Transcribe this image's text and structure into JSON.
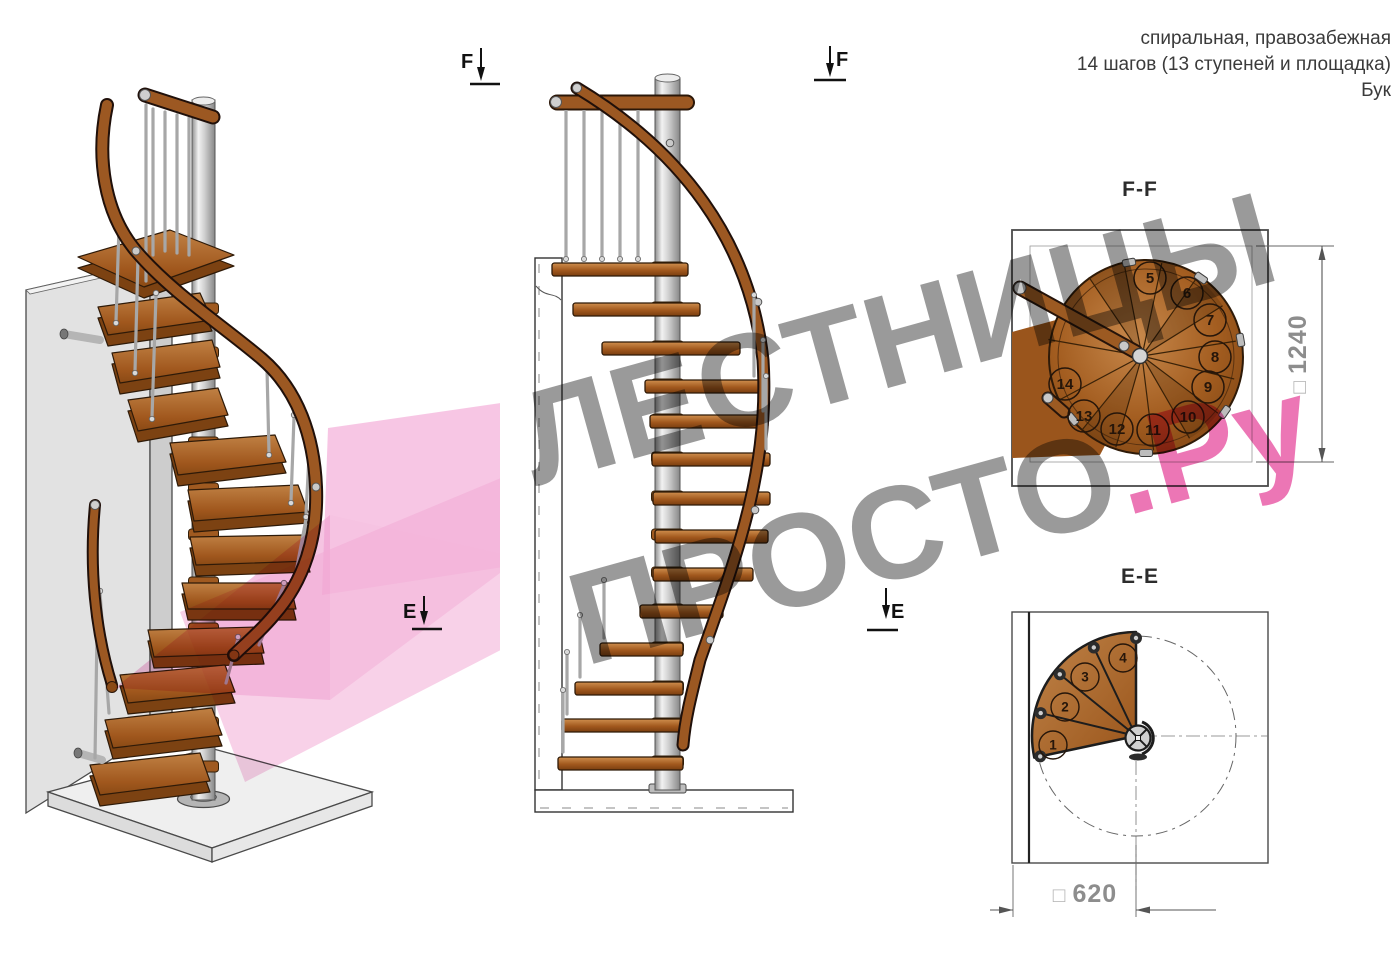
{
  "header": {
    "line1": "спиральная, правозабежная",
    "line2": "14 шагов (13 ступеней и площадка)",
    "line3": "Бук"
  },
  "markers": {
    "f": "F",
    "e": "E"
  },
  "watermark": {
    "line1": "ЛЕСТНИЦЫ",
    "line2_gray": "ПРОСТО",
    "line2_pink": ".Ру"
  },
  "plan_ff": {
    "title": "F-F",
    "dim_prefix": "□",
    "dim_value": "1240",
    "steps": [
      "5",
      "6",
      "7",
      "8",
      "9",
      "10",
      "11",
      "12",
      "13",
      "14"
    ]
  },
  "plan_ee": {
    "title": "E-E",
    "dim_prefix": "□",
    "dim_value": "620",
    "steps": [
      "1",
      "2",
      "3",
      "4"
    ]
  },
  "colors": {
    "wood": "#a05a1e",
    "wood_dark": "#7c4212",
    "metal": "#c9c9c9",
    "accent_pink": "#e96fb4",
    "watermark_gray": "#9a9a9a",
    "line": "#333333"
  }
}
